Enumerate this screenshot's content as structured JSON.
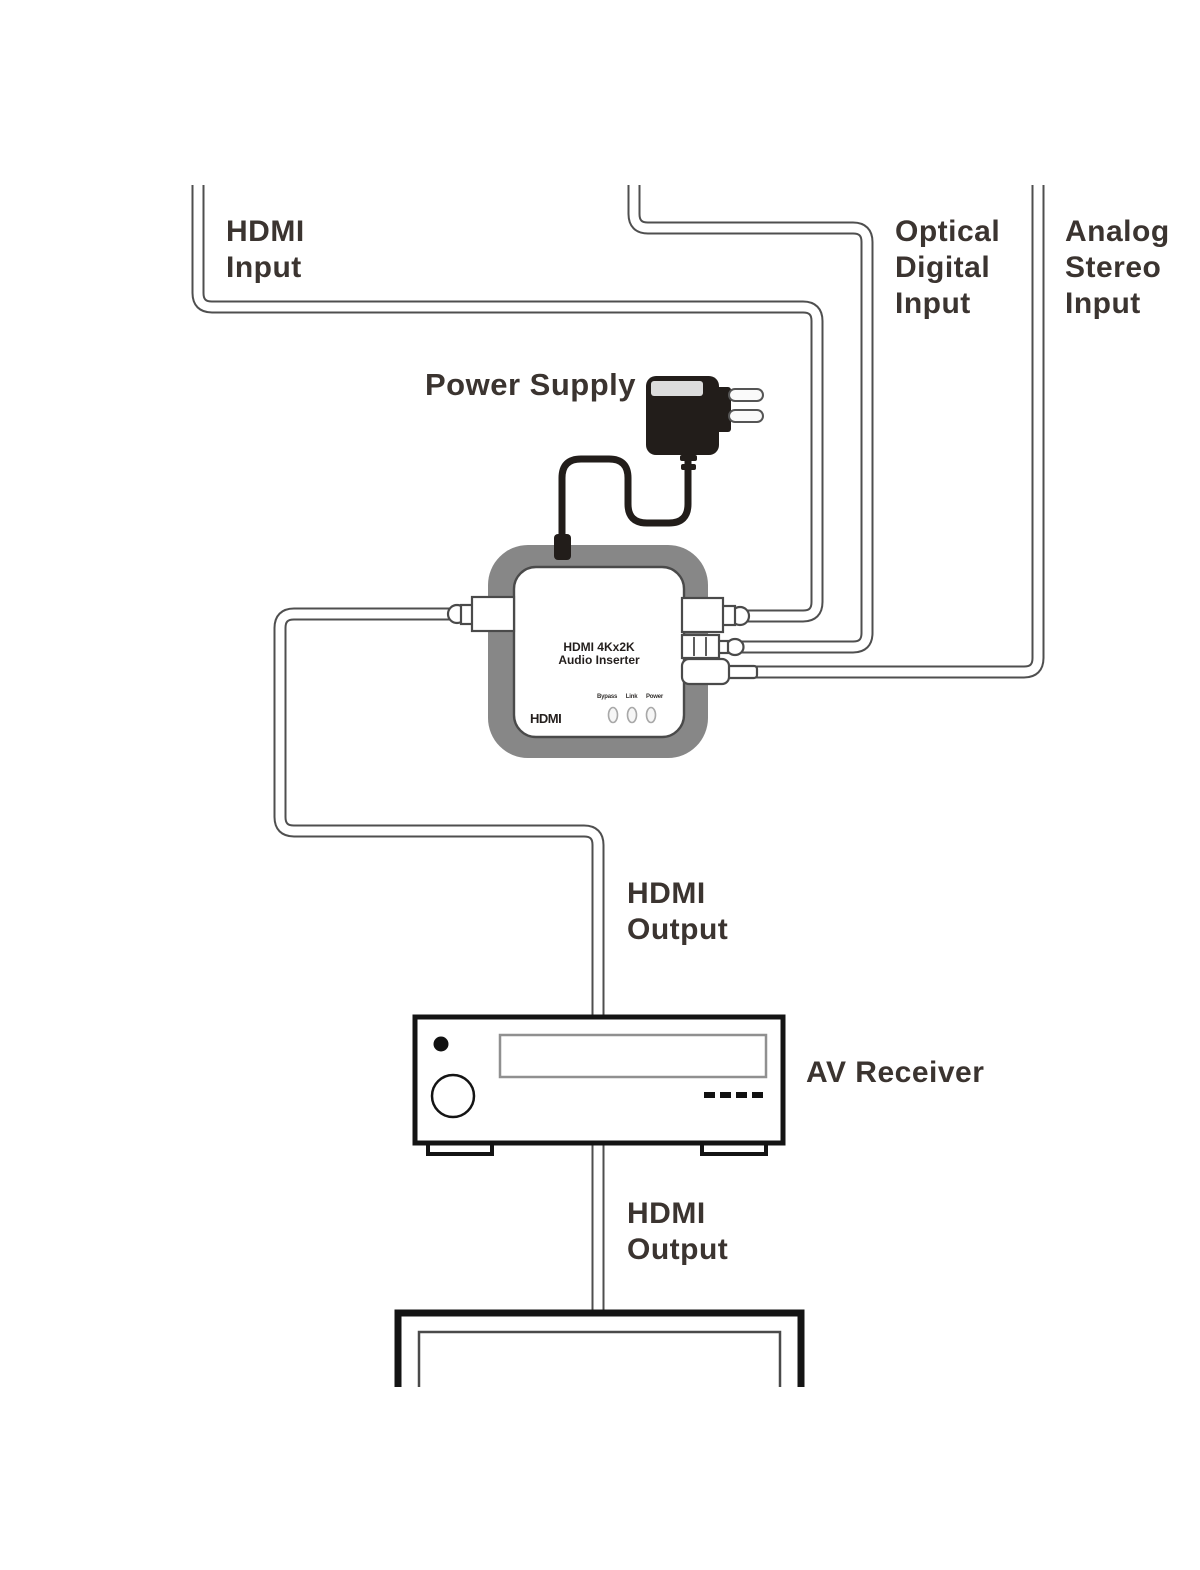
{
  "labels": {
    "hdmi_input": "HDMI\nInput",
    "optical_digital_input": "Optical\nDigital\nInput",
    "analog_stereo_input": "Analog\nStereo\nInput",
    "power_supply": "Power Supply",
    "hdmi_output_receiver": "HDMI\nOutput",
    "av_receiver": "AV Receiver",
    "hdmi_output_tv": "HDMI\nOutput"
  },
  "device": {
    "title_line1": "HDMI 4Kx2K",
    "title_line2": "Audio Inserter",
    "logo": "HDMI",
    "led_labels": [
      "Bypass",
      "Link",
      "Power"
    ]
  },
  "colors": {
    "text-color": "#3b3430",
    "cable-color": "#4f4f4f",
    "frame-gray": "#878787",
    "adapter-black": "#221d1a",
    "outline-dark": "#141414",
    "connector-stroke": "#4a4a4a"
  }
}
